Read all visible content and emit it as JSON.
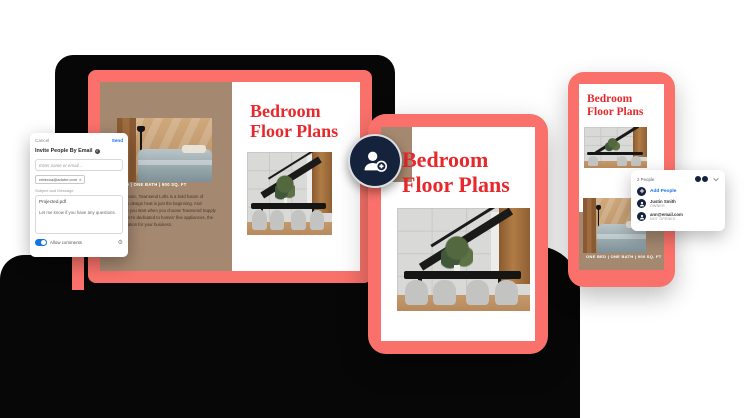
{
  "document": {
    "title_line1": "Bedroom",
    "title_line2": "Floor Plans",
    "caption": "ONE BED | ONE BATH | 900 SQ. FT",
    "body_lines": [
      "and iconic, Townsend Lofts is a bold fusion of",
      "porary design heat is just the beginning. And",
      "where you start when you choose Townsend Supply",
      "find we're dedicated to homes' fine appliances, the",
      "foundation for your business."
    ]
  },
  "invite_modal": {
    "cancel_label": "Cancel",
    "send_label": "Send",
    "title": "Invite People By Email",
    "info_glyph": "i",
    "recipient_placeholder": "Enter name or email...",
    "recipient_chip": "rebecca@adobe.com",
    "chip_remove_glyph": "×",
    "subject_label": "Subject and Message",
    "subject_value": "Projected.pdf",
    "message_value": "Let me know if you have any questions.",
    "allow_comments_label": "Allow comments",
    "toggle_state": "on",
    "gear_glyph": "⚙"
  },
  "people_popup": {
    "header": "2 People",
    "add_people_label": "Add People",
    "members": [
      {
        "name": "Justin Smith",
        "status": "OWNER"
      },
      {
        "name": "ann@email.com",
        "status": "NOT OPENED"
      }
    ]
  },
  "icons": {
    "badge": "add-person-icon",
    "popup_rows": "person-icon",
    "header_control": "chevron-down-icon"
  },
  "colors": {
    "coral": "#F9716A",
    "page_taupe": "#A58870",
    "title_red": "#E7282D",
    "navy": "#15223C",
    "accent_blue": "#1473E6",
    "chassis_black": "#070708"
  }
}
